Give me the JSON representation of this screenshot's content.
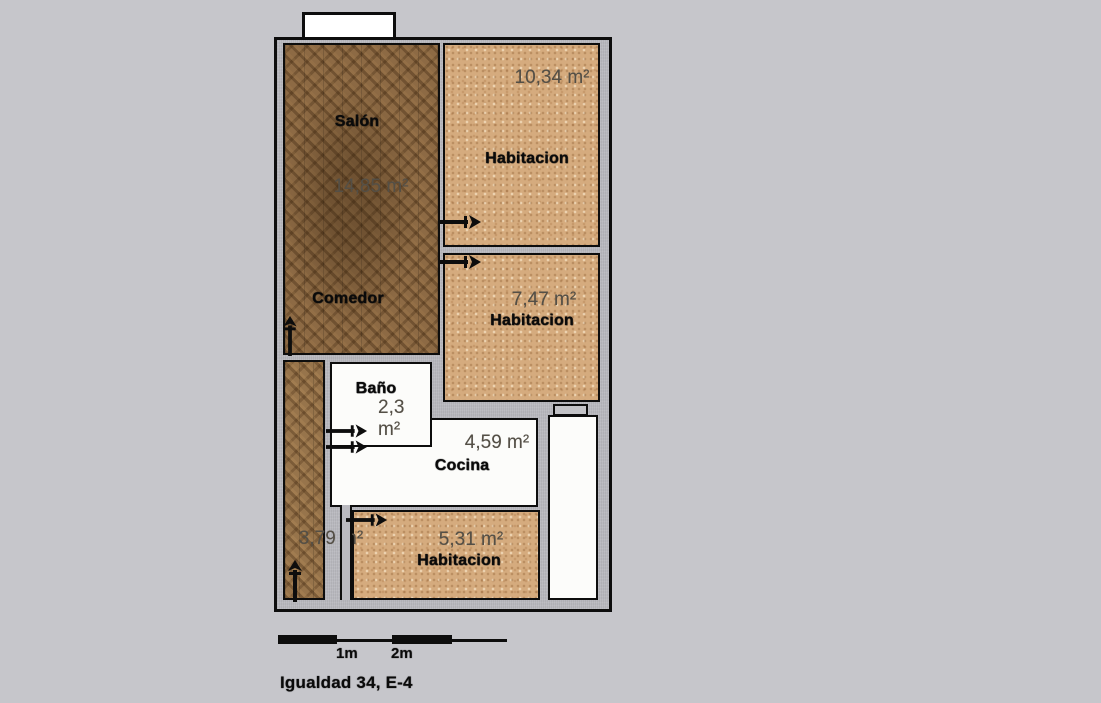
{
  "footer_label": "Igualdad 34, E-4",
  "floor_plan": {
    "rooms": [
      {
        "key": "salon-comedor",
        "labels": [
          "Salón",
          "Comedor"
        ],
        "area": "14,85 m²",
        "floor": "wood"
      },
      {
        "key": "bedroom-1",
        "labels": [
          "Habitacion"
        ],
        "area": "10,34 m²",
        "floor": "sand"
      },
      {
        "key": "bedroom-2",
        "labels": [
          "Habitacion"
        ],
        "area": "7,47 m²",
        "floor": "sand"
      },
      {
        "key": "bathroom",
        "labels": [
          "Baño"
        ],
        "area": "2,3 m²",
        "floor": "white"
      },
      {
        "key": "kitchen",
        "labels": [
          "Cocina"
        ],
        "area": "4,59 m²",
        "floor": "white"
      },
      {
        "key": "hallway",
        "labels": [],
        "area": "3,79 m²",
        "floor": "wood"
      },
      {
        "key": "bedroom-3",
        "labels": [
          "Habitacion"
        ],
        "area": "5,31 m²",
        "floor": "sand"
      },
      {
        "key": "gallery",
        "labels": [],
        "area": "",
        "floor": "white"
      }
    ],
    "doors": [
      {
        "into": "salon-comedor",
        "direction": "up"
      },
      {
        "into": "bedroom-1",
        "direction": "right"
      },
      {
        "into": "bedroom-2",
        "direction": "right"
      },
      {
        "into": "bathroom",
        "direction": "right"
      },
      {
        "into": "kitchen",
        "direction": "right"
      },
      {
        "into": "bedroom-3",
        "direction": "right"
      },
      {
        "into": "hallway-entrance",
        "direction": "up"
      }
    ],
    "balcony": true
  },
  "scale_bar": {
    "ticks": [
      "1m",
      "2m"
    ]
  },
  "colors": {
    "page_background": "#c6c6cb",
    "wall_fill": "#b9b9bf",
    "outline": "#0d0d0d",
    "wood_floor": "#8d6a44",
    "sand_floor": "#d5ab7e",
    "white_floor": "#fcfcfa",
    "area_text": "#544f46",
    "name_text": "#0a0a0a"
  }
}
